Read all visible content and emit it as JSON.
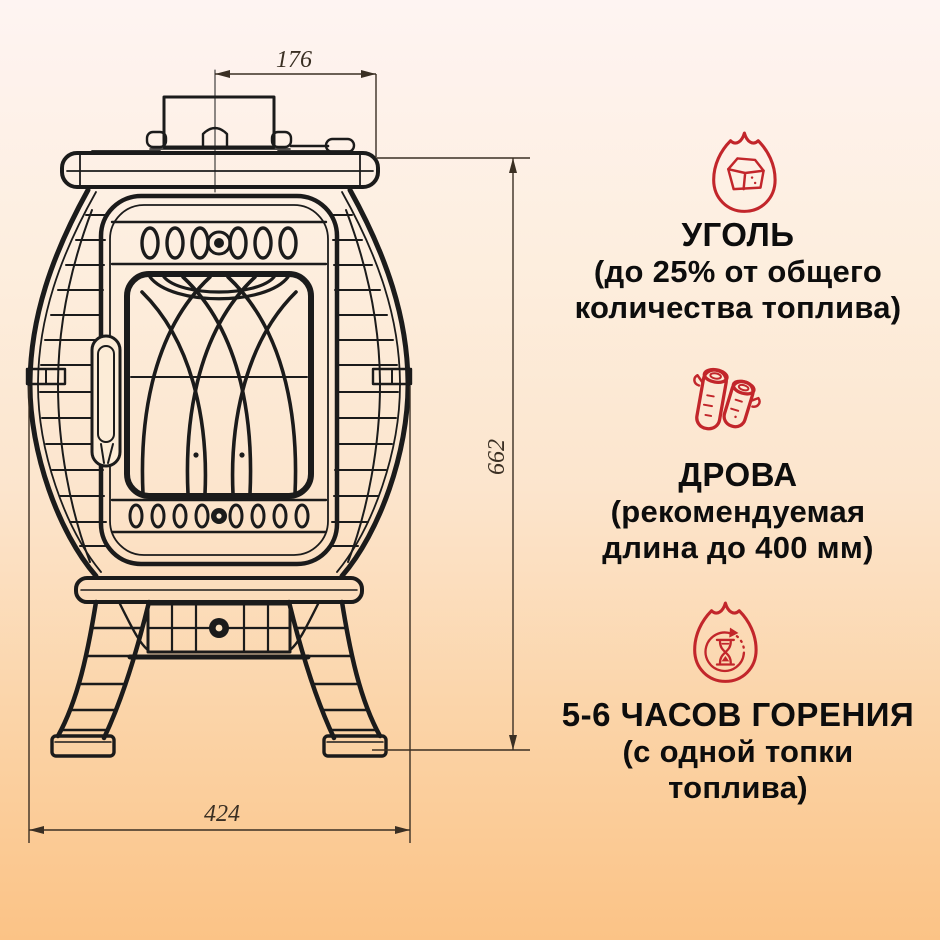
{
  "palette": {
    "bg_top": "#fef4f2",
    "bg_mid": "#fce5cd",
    "bg_bottom": "#fbc386",
    "accent_red": "#c2262b",
    "ink": "#1b1b1b",
    "dim_ink": "#3a2f23",
    "text": "#0d0d0d"
  },
  "diagram": {
    "dim_top_width": "176",
    "dim_height": "662",
    "dim_bottom_width": "424"
  },
  "features": [
    {
      "icon": "coal-flame-icon",
      "title": "УГОЛЬ",
      "lines": [
        "(до 25% от общего",
        "количества топлива)"
      ]
    },
    {
      "icon": "logs-icon",
      "title": "ДРОВА",
      "lines": [
        "(рекомендуемая",
        "длина до 400 мм)"
      ]
    },
    {
      "icon": "burn-time-flame-hourglass-icon",
      "title": "5-6 ЧАСОВ ГОРЕНИЯ",
      "lines": [
        "(с одной топки",
        "топлива)"
      ]
    }
  ]
}
